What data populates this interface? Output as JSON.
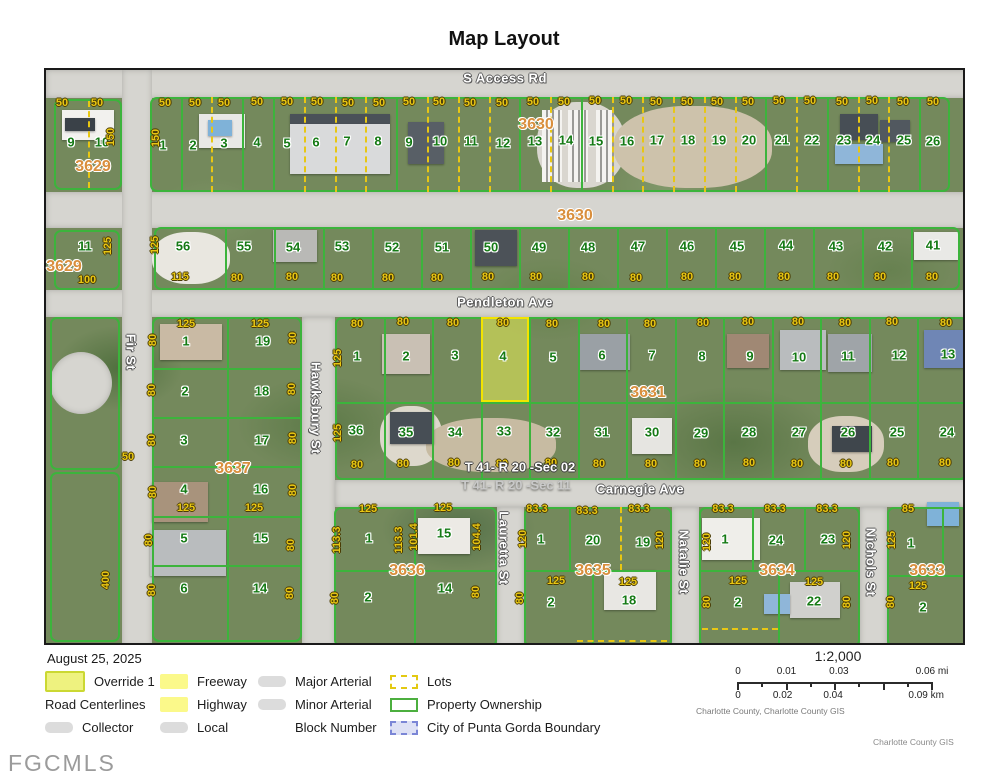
{
  "title": "Map Layout",
  "watermark": "FGCMLS",
  "footer": {
    "date": "August 25, 2025",
    "attribution": "Charlotte County, Charlotte County GIS",
    "credit": "Charlotte County GIS"
  },
  "legend": {
    "columns": [
      {
        "items": [
          {
            "label": "Override 1",
            "swatch": "override"
          },
          {
            "label": "Road Centerlines",
            "swatch": "none",
            "indent": false
          },
          {
            "label": "Collector",
            "swatch": "road"
          }
        ]
      },
      {
        "items": [
          {
            "label": "Freeway",
            "swatch": "freeway"
          },
          {
            "label": "Highway",
            "swatch": "highway"
          },
          {
            "label": "Local",
            "swatch": "road"
          }
        ]
      },
      {
        "items": [
          {
            "label": "Major Arterial",
            "swatch": "road"
          },
          {
            "label": "Minor Arterial",
            "swatch": "road"
          },
          {
            "label": "Block Number",
            "swatch": "none",
            "indent": true
          }
        ]
      },
      {
        "items": [
          {
            "label": "Lots",
            "swatch": "lots"
          },
          {
            "label": "Property Ownership",
            "swatch": "ownership"
          },
          {
            "label": "City of Punta Gorda Boundary",
            "swatch": "boundary"
          }
        ]
      }
    ]
  },
  "scalebar": {
    "ratio": "1:2,000",
    "mi": [
      [
        "0",
        0
      ],
      [
        "0.01",
        25
      ],
      [
        "0.03",
        52
      ],
      [
        "0.06 mi",
        100
      ]
    ],
    "km": [
      [
        "0",
        0
      ],
      [
        "0.02",
        23
      ],
      [
        "0.04",
        49
      ],
      [
        "0.09 km",
        97
      ]
    ]
  },
  "map": {
    "highlighted_lot": "4",
    "streets": [
      [
        "S Access Rd",
        505,
        78,
        "h"
      ],
      [
        "Pendleton Ave",
        505,
        302,
        "h"
      ],
      [
        "Carnegie Ave",
        640,
        489,
        "h"
      ],
      [
        "Fir St",
        131,
        352,
        "v"
      ],
      [
        "Hawksbury St",
        316,
        408,
        "v"
      ],
      [
        "Lauretta St",
        504,
        548,
        "v"
      ],
      [
        "Natalie St",
        684,
        562,
        "v"
      ],
      [
        "Nichols St",
        871,
        562,
        "v"
      ]
    ],
    "blocks": [
      [
        "3629",
        93,
        167
      ],
      [
        "3629",
        64,
        267
      ],
      [
        "3630",
        536,
        125
      ],
      [
        "3630",
        575,
        216
      ],
      [
        "3631",
        648,
        393
      ],
      [
        "3637",
        233,
        469
      ],
      [
        "3636",
        407,
        571
      ],
      [
        "3635",
        593,
        571
      ],
      [
        "3634",
        777,
        571
      ],
      [
        "3633",
        927,
        571
      ]
    ],
    "sections": [
      [
        "T 41- R 20 -Sec 02",
        520,
        467
      ],
      [
        "T 41- R 20 -Sec 11",
        516,
        485
      ]
    ],
    "lots": [
      [
        "9",
        71,
        142
      ],
      [
        "10",
        102,
        142
      ],
      [
        "1",
        163,
        145
      ],
      [
        "2",
        193,
        145
      ],
      [
        "3",
        224,
        143
      ],
      [
        "4",
        257,
        142
      ],
      [
        "5",
        287,
        143
      ],
      [
        "6",
        316,
        142
      ],
      [
        "7",
        347,
        141
      ],
      [
        "8",
        378,
        141
      ],
      [
        "9",
        409,
        142
      ],
      [
        "10",
        440,
        141
      ],
      [
        "11",
        471,
        141
      ],
      [
        "12",
        503,
        143
      ],
      [
        "13",
        535,
        141
      ],
      [
        "14",
        566,
        140
      ],
      [
        "15",
        596,
        141
      ],
      [
        "16",
        627,
        141
      ],
      [
        "17",
        657,
        140
      ],
      [
        "18",
        688,
        140
      ],
      [
        "19",
        719,
        140
      ],
      [
        "20",
        749,
        140
      ],
      [
        "21",
        782,
        140
      ],
      [
        "22",
        812,
        140
      ],
      [
        "23",
        844,
        140
      ],
      [
        "24",
        873,
        140
      ],
      [
        "25",
        904,
        140
      ],
      [
        "26",
        933,
        141
      ],
      [
        "11",
        85,
        246
      ],
      [
        "56",
        183,
        246
      ],
      [
        "55",
        244,
        246
      ],
      [
        "54",
        293,
        247
      ],
      [
        "53",
        342,
        246
      ],
      [
        "52",
        392,
        247
      ],
      [
        "51",
        442,
        247
      ],
      [
        "50",
        491,
        247
      ],
      [
        "49",
        539,
        247
      ],
      [
        "48",
        588,
        247
      ],
      [
        "47",
        638,
        246
      ],
      [
        "46",
        687,
        246
      ],
      [
        "45",
        737,
        246
      ],
      [
        "44",
        786,
        245
      ],
      [
        "43",
        836,
        246
      ],
      [
        "42",
        885,
        246
      ],
      [
        "41",
        933,
        245
      ],
      [
        "1",
        186,
        341
      ],
      [
        "19",
        263,
        341
      ],
      [
        "2",
        185,
        391
      ],
      [
        "18",
        262,
        391
      ],
      [
        "3",
        184,
        440
      ],
      [
        "17",
        262,
        440
      ],
      [
        "4",
        184,
        489
      ],
      [
        "16",
        261,
        489
      ],
      [
        "5",
        184,
        538
      ],
      [
        "15",
        261,
        538
      ],
      [
        "6",
        184,
        588
      ],
      [
        "14",
        260,
        588
      ],
      [
        "1",
        357,
        356
      ],
      [
        "2",
        406,
        356
      ],
      [
        "3",
        455,
        355
      ],
      [
        "4",
        503,
        356
      ],
      [
        "5",
        553,
        357
      ],
      [
        "6",
        602,
        355
      ],
      [
        "7",
        652,
        355
      ],
      [
        "8",
        702,
        356
      ],
      [
        "9",
        750,
        356
      ],
      [
        "10",
        799,
        357
      ],
      [
        "11",
        848,
        356
      ],
      [
        "12",
        899,
        355
      ],
      [
        "13",
        948,
        354
      ],
      [
        "36",
        356,
        430
      ],
      [
        "35",
        406,
        432
      ],
      [
        "34",
        455,
        432
      ],
      [
        "33",
        504,
        431
      ],
      [
        "32",
        553,
        432
      ],
      [
        "31",
        602,
        432
      ],
      [
        "30",
        652,
        432
      ],
      [
        "29",
        701,
        433
      ],
      [
        "28",
        749,
        432
      ],
      [
        "27",
        799,
        432
      ],
      [
        "26",
        848,
        432
      ],
      [
        "25",
        897,
        432
      ],
      [
        "24",
        947,
        432
      ],
      [
        "1",
        369,
        538
      ],
      [
        "15",
        444,
        533
      ],
      [
        "2",
        368,
        597
      ],
      [
        "14",
        445,
        588
      ],
      [
        "1",
        541,
        539
      ],
      [
        "20",
        593,
        540
      ],
      [
        "19",
        643,
        542
      ],
      [
        "2",
        551,
        602
      ],
      [
        "18",
        629,
        600
      ],
      [
        "1",
        725,
        539
      ],
      [
        "24",
        776,
        540
      ],
      [
        "23",
        828,
        539
      ],
      [
        "2",
        738,
        602
      ],
      [
        "22",
        814,
        601
      ],
      [
        "1",
        911,
        543
      ],
      [
        "2",
        923,
        607
      ]
    ],
    "dims": [
      [
        "50",
        62,
        103
      ],
      [
        "50",
        97,
        103
      ],
      [
        "50",
        165,
        103
      ],
      [
        "50",
        195,
        103
      ],
      [
        "50",
        224,
        103
      ],
      [
        "50",
        257,
        102
      ],
      [
        "50",
        287,
        102
      ],
      [
        "50",
        317,
        102
      ],
      [
        "50",
        348,
        103
      ],
      [
        "50",
        379,
        103
      ],
      [
        "50",
        409,
        102
      ],
      [
        "50",
        439,
        102
      ],
      [
        "50",
        470,
        103
      ],
      [
        "50",
        502,
        103
      ],
      [
        "50",
        533,
        102
      ],
      [
        "50",
        564,
        102
      ],
      [
        "50",
        595,
        101
      ],
      [
        "50",
        626,
        101
      ],
      [
        "50",
        656,
        102
      ],
      [
        "50",
        687,
        102
      ],
      [
        "50",
        717,
        102
      ],
      [
        "50",
        748,
        102
      ],
      [
        "50",
        779,
        101
      ],
      [
        "50",
        810,
        101
      ],
      [
        "50",
        842,
        102
      ],
      [
        "50",
        872,
        101
      ],
      [
        "50",
        903,
        102
      ],
      [
        "50",
        933,
        102
      ],
      [
        "100",
        87,
        280
      ],
      [
        "115",
        180,
        277
      ],
      [
        "80",
        237,
        278
      ],
      [
        "80",
        292,
        277
      ],
      [
        "80",
        337,
        278
      ],
      [
        "80",
        388,
        278
      ],
      [
        "80",
        437,
        278
      ],
      [
        "80",
        488,
        277
      ],
      [
        "80",
        536,
        277
      ],
      [
        "80",
        588,
        277
      ],
      [
        "80",
        636,
        278
      ],
      [
        "80",
        687,
        277
      ],
      [
        "80",
        735,
        277
      ],
      [
        "80",
        784,
        277
      ],
      [
        "80",
        833,
        277
      ],
      [
        "80",
        880,
        277
      ],
      [
        "80",
        932,
        277
      ],
      [
        "80",
        357,
        324
      ],
      [
        "80",
        403,
        322
      ],
      [
        "80",
        453,
        323
      ],
      [
        "80",
        503,
        323
      ],
      [
        "80",
        552,
        324
      ],
      [
        "80",
        604,
        324
      ],
      [
        "80",
        650,
        324
      ],
      [
        "80",
        703,
        323
      ],
      [
        "80",
        748,
        322
      ],
      [
        "80",
        798,
        322
      ],
      [
        "80",
        845,
        323
      ],
      [
        "80",
        892,
        322
      ],
      [
        "80",
        946,
        323
      ],
      [
        "80",
        357,
        465
      ],
      [
        "80",
        403,
        464
      ],
      [
        "80",
        454,
        463
      ],
      [
        "80",
        502,
        464
      ],
      [
        "80",
        551,
        463
      ],
      [
        "80",
        599,
        464
      ],
      [
        "80",
        651,
        464
      ],
      [
        "80",
        700,
        464
      ],
      [
        "80",
        749,
        463
      ],
      [
        "80",
        797,
        464
      ],
      [
        "80",
        846,
        464
      ],
      [
        "80",
        893,
        463
      ],
      [
        "80",
        945,
        463
      ],
      [
        "125",
        186,
        324
      ],
      [
        "125",
        260,
        324
      ],
      [
        "125",
        186,
        508
      ],
      [
        "125",
        254,
        508
      ],
      [
        "50",
        128,
        457
      ],
      [
        "125",
        368,
        509
      ],
      [
        "125",
        443,
        508
      ],
      [
        "83.3",
        537,
        509
      ],
      [
        "83.3",
        587,
        511
      ],
      [
        "83.3",
        639,
        509
      ],
      [
        "125",
        556,
        581
      ],
      [
        "125",
        628,
        582
      ],
      [
        "83.3",
        723,
        509
      ],
      [
        "83.3",
        775,
        509
      ],
      [
        "83.3",
        827,
        509
      ],
      [
        "125",
        738,
        581
      ],
      [
        "125",
        814,
        582
      ],
      [
        "85",
        908,
        509
      ],
      [
        "125",
        918,
        586
      ]
    ],
    "dims_v": [
      [
        "150",
        111,
        137
      ],
      [
        "150",
        156,
        138
      ],
      [
        "125",
        108,
        246
      ],
      [
        "125",
        155,
        245
      ],
      [
        "125",
        338,
        358
      ],
      [
        "125",
        338,
        433
      ],
      [
        "80",
        153,
        340
      ],
      [
        "80",
        293,
        338
      ],
      [
        "80",
        152,
        390
      ],
      [
        "80",
        292,
        389
      ],
      [
        "80",
        152,
        440
      ],
      [
        "80",
        293,
        438
      ],
      [
        "80",
        153,
        492
      ],
      [
        "80",
        293,
        490
      ],
      [
        "80",
        149,
        540
      ],
      [
        "80",
        291,
        545
      ],
      [
        "80",
        152,
        590
      ],
      [
        "80",
        290,
        593
      ],
      [
        "400",
        106,
        580
      ],
      [
        "113.3",
        337,
        540
      ],
      [
        "113.3",
        399,
        540
      ],
      [
        "101.4",
        414,
        537
      ],
      [
        "104.4",
        477,
        537
      ],
      [
        "80",
        335,
        598
      ],
      [
        "80",
        476,
        592
      ],
      [
        "120",
        523,
        539
      ],
      [
        "120",
        660,
        540
      ],
      [
        "80",
        520,
        598
      ],
      [
        "120",
        707,
        542
      ],
      [
        "120",
        847,
        540
      ],
      [
        "80",
        707,
        602
      ],
      [
        "80",
        847,
        602
      ],
      [
        "125",
        892,
        540
      ],
      [
        "80",
        891,
        602
      ]
    ]
  },
  "colors": {
    "parcel_outline": "#3cb43c",
    "lot_number": "#157a15",
    "dimension_text": "#e9c713",
    "block_number": "#d98f3d",
    "highlight_fill": "#e9ef55",
    "highlight_border": "#f2e400",
    "boundary_blue": "#7b86d6",
    "road_gray": "#d6d5d0"
  }
}
